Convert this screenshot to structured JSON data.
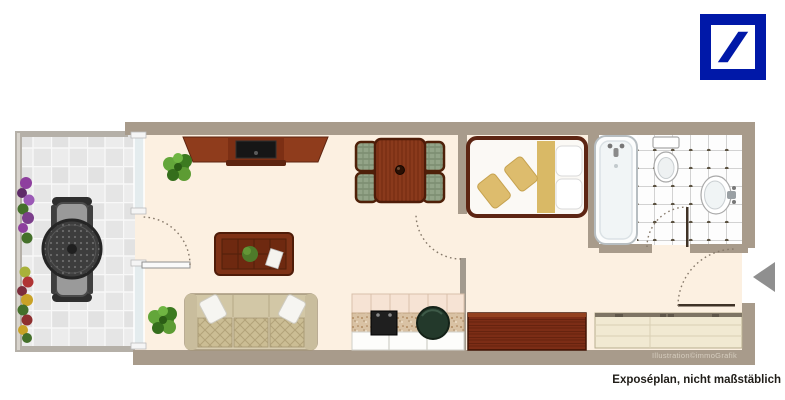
{
  "captions": {
    "credit": "Illustration©immoGrafik",
    "disclaimer": "Exposéplan, nicht maßstäblich"
  },
  "logo": {
    "icon": "deutsche-bank-slash-logo",
    "color": "#0018A8"
  },
  "palette": {
    "wall": "#a89b8b",
    "apartment_floor": "#fcf0e1",
    "balcony_tile": "#e9e9e9",
    "bathroom_tile": "#fdfdfd",
    "wood_red_dark": "#7c2d16",
    "wood_sienna": "#8a3a1c",
    "sofa_beige": "#d8cdb0",
    "bed_gold": "#ddbc6d",
    "chair_plaid_green": "#93a488",
    "plant_green": "#4f8f2d",
    "entry_arrow_gray": "#8f8f8f",
    "door_arc": "#86796a"
  },
  "regions": [
    "balcony",
    "living-area",
    "dining-area",
    "kitchen",
    "sleeping-area",
    "bathroom",
    "hallway-entrance"
  ]
}
